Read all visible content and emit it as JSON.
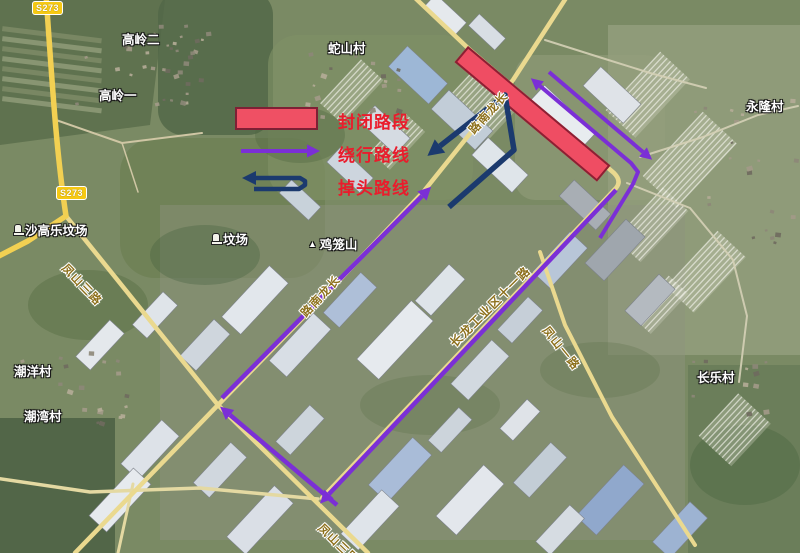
{
  "legend": {
    "closed_label": "封闭路段",
    "detour_label": "绕行路线",
    "uturn_label": "掉头路线"
  },
  "shields": {
    "s273_top": "S273",
    "s273_mid": "S273"
  },
  "places": {
    "gaoling_er": "高岭二",
    "gaoling_yi": "高岭一",
    "sheshancun": "蛇山村",
    "yonglongcun": "永隆村",
    "shagaole_cemetery": "沙高乐坟场",
    "cemetery": "坟场",
    "jilongshan": "鸡笼山",
    "chaoyangcun": "潮洋村",
    "chaowancun": "潮湾村",
    "changlecun": "长乐村"
  },
  "roads": {
    "changlong_nan_upper": "长龙南路",
    "changlong_nan_mid": "长龙南路",
    "fengshan_san_upper": "凤山三路",
    "fengshan_san_lower": "凤山三路",
    "changlong_industrial_11": "长龙工业区十一路",
    "fengshan_yi": "凤山一路"
  },
  "colors": {
    "closed_fill": "#ef4d63",
    "closed_border": "#8c2033",
    "detour_purple": "#7b2fd6",
    "uturn_navy": "#1b3a6e",
    "legend_text_red": "#ea1c2c",
    "road_yellow": "#ead98f"
  }
}
